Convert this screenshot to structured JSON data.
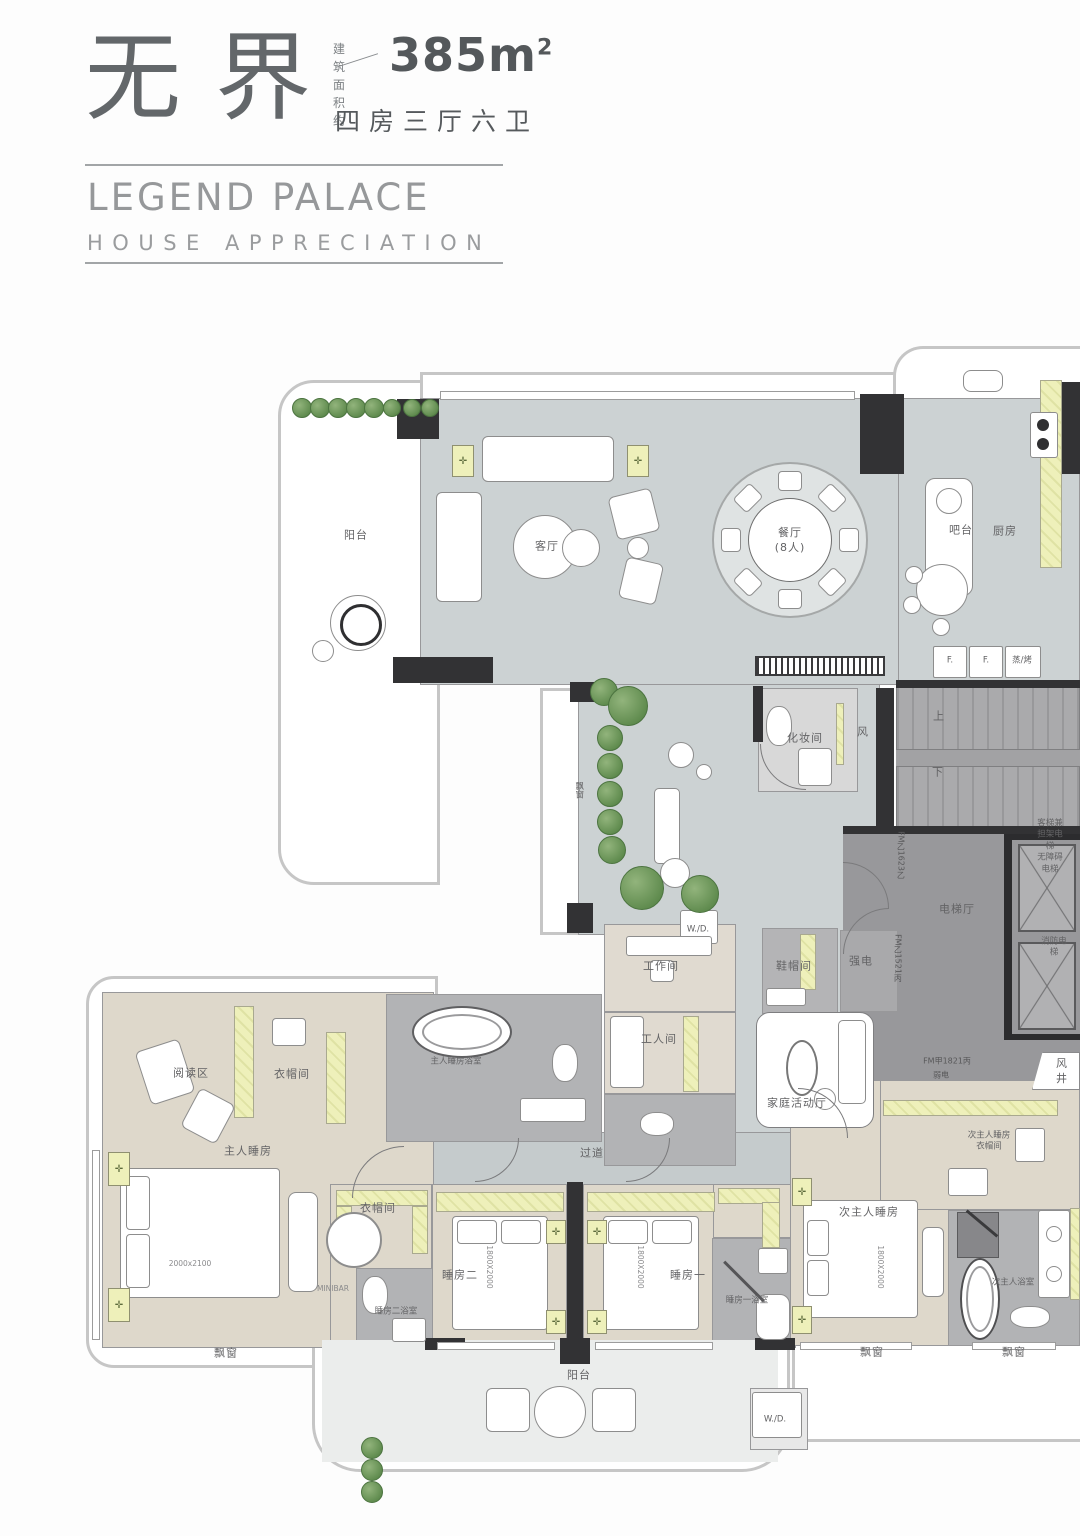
{
  "header": {
    "title_cn": "无界",
    "area_label": "建 筑\n面积约",
    "area_value": "385m",
    "area_exponent": "2",
    "spec": "四房三厅六卫",
    "name_en": "LEGEND PALACE",
    "subtitle_en": "HOUSE APPRECIATION"
  },
  "colors": {
    "wall": "#323234",
    "floor_public": "#ccd2d3",
    "floor_bedroom": "#ded8cb",
    "floor_bath": "#b2b3b5",
    "floor_core": "#98989a",
    "cabinet_highlight": "#eef0ba",
    "plant_green": "#5e8a4d",
    "title_gray": "#63676a",
    "subtitle_gray": "#96989a"
  },
  "plan": {
    "labels": [
      {
        "id": "balcony-top",
        "text": "阳台",
        "x": 356,
        "y": 536,
        "kind": "room"
      },
      {
        "id": "living-room",
        "text": "客厅",
        "x": 547,
        "y": 547,
        "kind": "room"
      },
      {
        "id": "dining-room",
        "text": "餐厅\n(8人)",
        "x": 790,
        "y": 541,
        "kind": "room"
      },
      {
        "id": "bar-counter",
        "text": "吧台",
        "x": 961,
        "y": 531,
        "kind": "room"
      },
      {
        "id": "kitchen",
        "text": "厨房",
        "x": 1005,
        "y": 532,
        "kind": "room"
      },
      {
        "id": "fridge-1",
        "text": "F.",
        "x": 950,
        "y": 661,
        "kind": "tiny"
      },
      {
        "id": "fridge-2",
        "text": "F.",
        "x": 986,
        "y": 661,
        "kind": "tiny"
      },
      {
        "id": "steam-oven",
        "text": "蒸/烤",
        "x": 1022,
        "y": 661,
        "kind": "tiny"
      },
      {
        "id": "powder-room",
        "text": "化妆间",
        "x": 805,
        "y": 739,
        "kind": "room"
      },
      {
        "id": "air-shaft-top",
        "text": "风",
        "x": 863,
        "y": 733,
        "kind": "room"
      },
      {
        "id": "stairs-up",
        "text": "上",
        "x": 939,
        "y": 717,
        "kind": "room"
      },
      {
        "id": "stairs-down",
        "text": "下",
        "x": 938,
        "y": 773,
        "kind": "room"
      },
      {
        "id": "elevator-hall",
        "text": "电梯厅",
        "x": 957,
        "y": 910,
        "kind": "room"
      },
      {
        "id": "passenger-elevator",
        "text": "客梯兼\n担架电梯\n无障碍电梯",
        "x": 1050,
        "y": 847,
        "kind": "tiny"
      },
      {
        "id": "fire-elevator",
        "text": "消防电梯",
        "x": 1054,
        "y": 948,
        "kind": "tiny"
      },
      {
        "id": "fm-door-1623",
        "text": "FM乙1623乙",
        "x": 900,
        "y": 855,
        "kind": "code",
        "v": true
      },
      {
        "id": "fm-door-1521",
        "text": "FM乙1521丙",
        "x": 897,
        "y": 958,
        "kind": "code",
        "v": true
      },
      {
        "id": "shoe-room",
        "text": "鞋帽间",
        "x": 794,
        "y": 967,
        "kind": "room"
      },
      {
        "id": "strong-electric",
        "text": "强电",
        "x": 861,
        "y": 962,
        "kind": "room"
      },
      {
        "id": "family-room",
        "text": "家庭活动厅",
        "x": 797,
        "y": 1104,
        "kind": "room"
      },
      {
        "id": "fm-door-1821",
        "text": "FM甲1821丙",
        "x": 947,
        "y": 1062,
        "kind": "code"
      },
      {
        "id": "weak-electric",
        "text": "弱电",
        "x": 941,
        "y": 1076,
        "kind": "code"
      },
      {
        "id": "air-shaft-right",
        "text": "风井",
        "x": 1062,
        "y": 1072,
        "kind": "room"
      },
      {
        "id": "washer-dryer-top",
        "text": "W./D.",
        "x": 698,
        "y": 930,
        "kind": "tiny"
      },
      {
        "id": "work-room",
        "text": "工作间",
        "x": 661,
        "y": 967,
        "kind": "room"
      },
      {
        "id": "maid-room",
        "text": "工人间",
        "x": 659,
        "y": 1040,
        "kind": "room"
      },
      {
        "id": "master-bathroom",
        "text": "主人睡房浴室",
        "x": 456,
        "y": 1062,
        "kind": "tiny"
      },
      {
        "id": "corridor",
        "text": "过道",
        "x": 592,
        "y": 1154,
        "kind": "room"
      },
      {
        "id": "reading-area",
        "text": "阅读区",
        "x": 191,
        "y": 1074,
        "kind": "room"
      },
      {
        "id": "master-closet",
        "text": "衣帽间",
        "x": 292,
        "y": 1075,
        "kind": "room"
      },
      {
        "id": "master-bedroom",
        "text": "主人睡房",
        "x": 248,
        "y": 1152,
        "kind": "room"
      },
      {
        "id": "master-bed-size",
        "text": "2000x2100",
        "x": 190,
        "y": 1264,
        "kind": "dim"
      },
      {
        "id": "closet-2",
        "text": "衣帽间",
        "x": 378,
        "y": 1209,
        "kind": "room"
      },
      {
        "id": "minibar",
        "text": "MINIBAR",
        "x": 333,
        "y": 1289,
        "kind": "dim"
      },
      {
        "id": "bedroom-2-bath",
        "text": "睡房二浴室",
        "x": 396,
        "y": 1312,
        "kind": "tiny"
      },
      {
        "id": "bay-window-master",
        "text": "飘窗",
        "x": 226,
        "y": 1354,
        "kind": "room"
      },
      {
        "id": "bedroom-2",
        "text": "睡房二",
        "x": 460,
        "y": 1276,
        "kind": "room"
      },
      {
        "id": "bed-2-size",
        "text": "1800X2000",
        "x": 489,
        "y": 1267,
        "kind": "dim",
        "v": true
      },
      {
        "id": "bedroom-1",
        "text": "睡房一",
        "x": 688,
        "y": 1276,
        "kind": "room"
      },
      {
        "id": "bed-1-size",
        "text": "1800X2000",
        "x": 640,
        "y": 1267,
        "kind": "dim",
        "v": true
      },
      {
        "id": "bedroom-1-bath",
        "text": "睡房一浴室",
        "x": 747,
        "y": 1301,
        "kind": "tiny"
      },
      {
        "id": "balcony-bottom",
        "text": "阳台",
        "x": 579,
        "y": 1376,
        "kind": "room"
      },
      {
        "id": "washer-dryer-bottom",
        "text": "W./D.",
        "x": 775,
        "y": 1420,
        "kind": "tiny"
      },
      {
        "id": "second-master-closet",
        "text": "次主人睡房\n衣帽间",
        "x": 989,
        "y": 1142,
        "kind": "tiny"
      },
      {
        "id": "second-master-bedroom",
        "text": "次主人睡房",
        "x": 869,
        "y": 1213,
        "kind": "room"
      },
      {
        "id": "second-master-bed-size",
        "text": "1800X2000",
        "x": 880,
        "y": 1267,
        "kind": "dim",
        "v": true
      },
      {
        "id": "second-master-bath",
        "text": "次主人浴室",
        "x": 1013,
        "y": 1283,
        "kind": "tiny"
      },
      {
        "id": "bay-window-sm",
        "text": "飘窗",
        "x": 872,
        "y": 1353,
        "kind": "room"
      },
      {
        "id": "bay-window-right",
        "text": "飘窗",
        "x": 1014,
        "y": 1353,
        "kind": "room"
      },
      {
        "id": "bay-window-garden",
        "text": "飘窗",
        "x": 578,
        "y": 790,
        "kind": "tiny",
        "v": true
      }
    ]
  }
}
